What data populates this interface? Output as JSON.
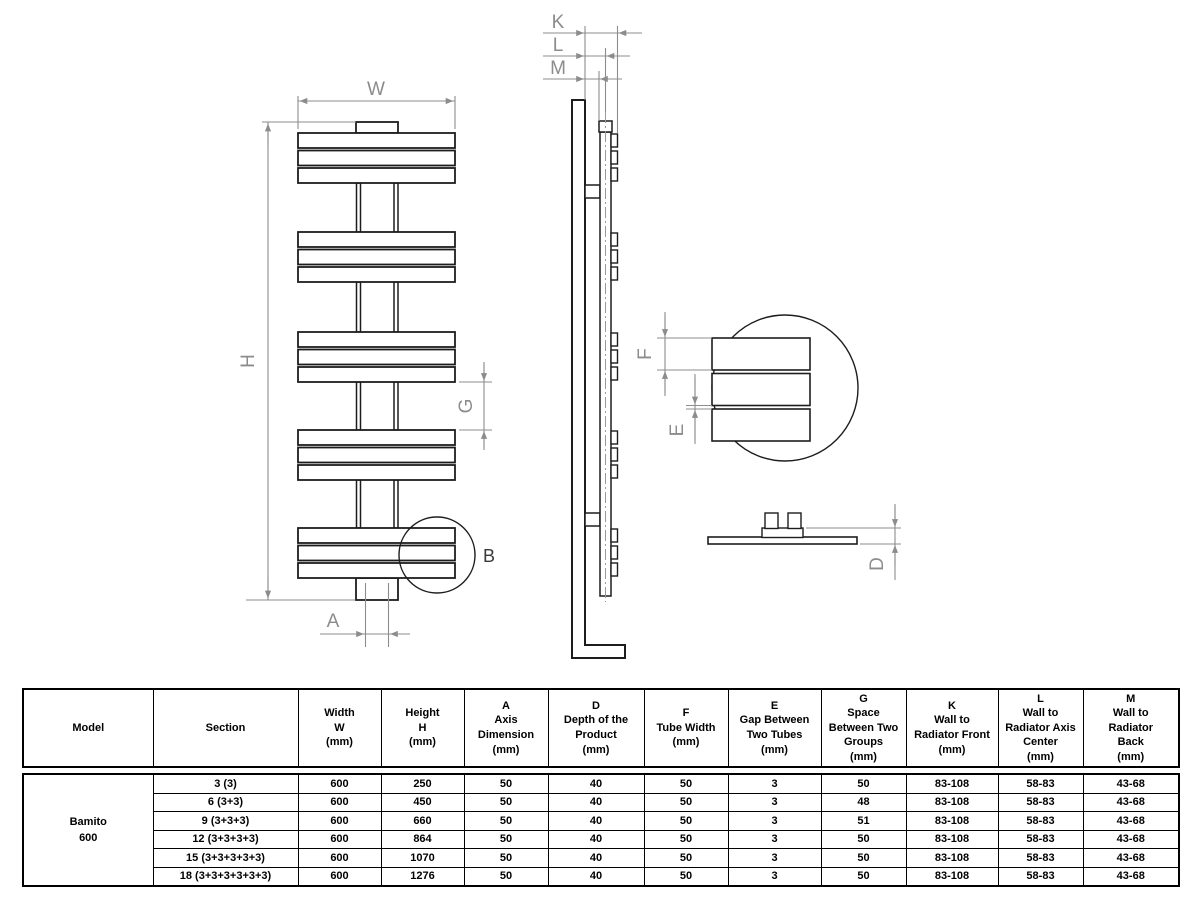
{
  "drawing": {
    "dim_labels": {
      "width": "W",
      "height": "H",
      "group_space": "G",
      "axis": "A",
      "detail": "B",
      "wall_front": "K",
      "wall_axis": "L",
      "wall_back": "M",
      "tube_width": "F",
      "tube_gap": "E",
      "depth": "D"
    }
  },
  "table": {
    "headers": {
      "model": "Model",
      "section": "Section",
      "width": "Width\nW\n(mm)",
      "height": "Height\nH\n(mm)",
      "axis": "A\nAxis\nDimension\n(mm)",
      "depth": "D\nDepth of the\nProduct\n(mm)",
      "tube_width": "F\nTube Width\n(mm)",
      "tube_gap": "E\nGap Between\nTwo Tubes\n(mm)",
      "group_space": "G\nSpace\nBetween Two\nGroups\n(mm)",
      "wall_front": "K\nWall to\nRadiator Front\n(mm)",
      "wall_axis": "L\nWall to\nRadiator Axis\nCenter\n(mm)",
      "wall_back": "M\nWall to\nRadiator\nBack\n(mm)"
    },
    "model": "Bamito\n600",
    "rows": [
      {
        "section": "3 (3)",
        "w": "600",
        "h": "250",
        "a": "50",
        "d": "40",
        "f": "50",
        "e": "3",
        "g": "50",
        "k": "83-108",
        "l": "58-83",
        "m": "43-68"
      },
      {
        "section": "6 (3+3)",
        "w": "600",
        "h": "450",
        "a": "50",
        "d": "40",
        "f": "50",
        "e": "3",
        "g": "48",
        "k": "83-108",
        "l": "58-83",
        "m": "43-68"
      },
      {
        "section": "9 (3+3+3)",
        "w": "600",
        "h": "660",
        "a": "50",
        "d": "40",
        "f": "50",
        "e": "3",
        "g": "51",
        "k": "83-108",
        "l": "58-83",
        "m": "43-68"
      },
      {
        "section": "12 (3+3+3+3)",
        "w": "600",
        "h": "864",
        "a": "50",
        "d": "40",
        "f": "50",
        "e": "3",
        "g": "50",
        "k": "83-108",
        "l": "58-83",
        "m": "43-68"
      },
      {
        "section": "15 (3+3+3+3+3)",
        "w": "600",
        "h": "1070",
        "a": "50",
        "d": "40",
        "f": "50",
        "e": "3",
        "g": "50",
        "k": "83-108",
        "l": "58-83",
        "m": "43-68"
      },
      {
        "section": "18 (3+3+3+3+3+3)",
        "w": "600",
        "h": "1276",
        "a": "50",
        "d": "40",
        "f": "50",
        "e": "3",
        "g": "50",
        "k": "83-108",
        "l": "58-83",
        "m": "43-68"
      }
    ]
  },
  "colors": {
    "line": "#1d1d1d",
    "dim": "#8c8c8c"
  }
}
